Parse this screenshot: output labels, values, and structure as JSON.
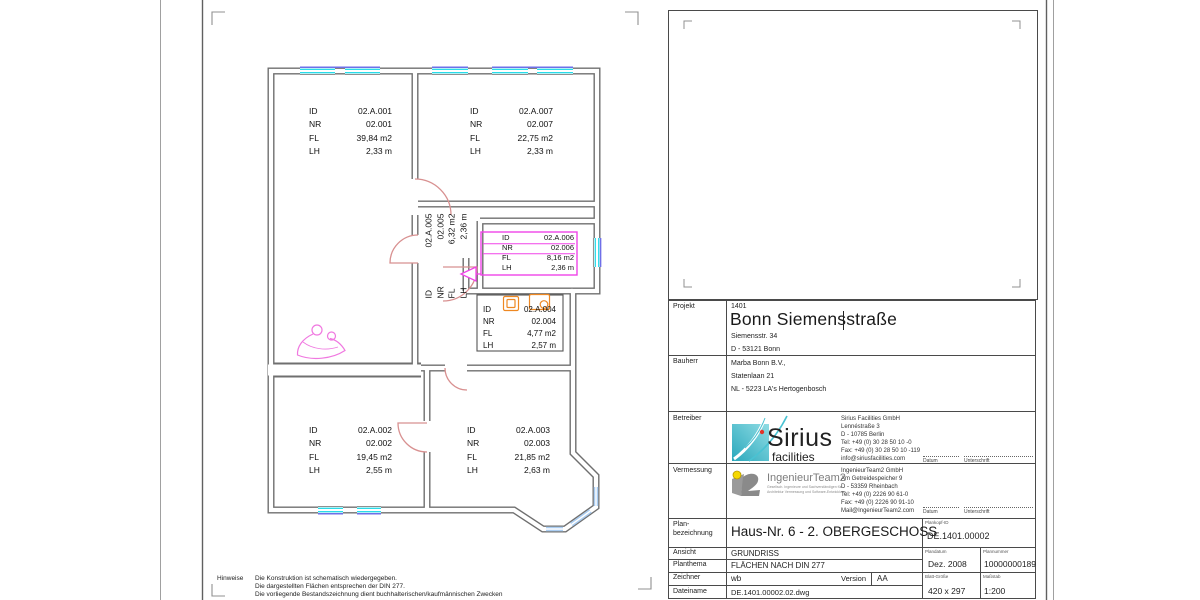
{
  "plan": {
    "labels": {
      "id": "ID",
      "nr": "NR",
      "fl": "FL",
      "lh": "LH"
    },
    "rooms": {
      "r001": {
        "id": "02.A.001",
        "nr": "02.001",
        "fl": "39,84 m2",
        "lh": "2,33 m"
      },
      "r002": {
        "id": "02.A.002",
        "nr": "02.002",
        "fl": "19,45 m2",
        "lh": "2,55 m"
      },
      "r003": {
        "id": "02.A.003",
        "nr": "02.003",
        "fl": "21,85 m2",
        "lh": "2,63 m"
      },
      "r004": {
        "id": "02.A.004",
        "nr": "02.004",
        "fl": "4,77 m2",
        "lh": "2,57 m"
      },
      "r005": {
        "id": "02.A.005",
        "nr": "02.005",
        "fl": "6,32 m2",
        "lh": "2,36 m"
      },
      "r006": {
        "id": "02.A.006",
        "nr": "02.006",
        "fl": "8,16 m2",
        "lh": "2,36 m"
      },
      "r007": {
        "id": "02.A.007",
        "nr": "02.007",
        "fl": "22,75 m2",
        "lh": "2,33 m"
      }
    }
  },
  "titleblock": {
    "projekt": {
      "label": "Projekt",
      "number": "1401",
      "title": "Bonn Siemensstraße",
      "street": "Siemensstr. 34",
      "city": "D - 53121 Bonn"
    },
    "bauherr": {
      "label": "Bauherr",
      "name": "Marba Bonn B.V.,",
      "street": "Statenlaan 21",
      "city": "NL - 5223 LA's Hertogenbosch"
    },
    "betreiber": {
      "label": "Betreiber",
      "logo_text": "Sirius",
      "logo_sub": "facilities",
      "company": "Sirius Facilities GmbH",
      "street": "Lennéstraße 3",
      "city": "D - 10785 Berlin",
      "tel": "Tel:  +49 (0) 30 28 50 10 -0",
      "fax": "Fax: +49 (0) 30 28 50 10 -119",
      "email": "info@siriusfacilities.com"
    },
    "vermessung": {
      "label": "Vermessung",
      "logo_text": "IngenieurTeam2",
      "tagline1": "Gesellsch. Ingenieure und Sachverständigen für",
      "tagline2": "Architektur Vermessung und Software-Entwicklung",
      "company": "IngenieurTeam2 GmbH",
      "street": "Am Getreidespeicher 9",
      "city": "D - 53359 Rheinbach",
      "tel": "Tel:  +49 (0) 2226 90 61-0",
      "fax": "Fax: +49 (0) 2226 90 91-10",
      "email": "Mail@IngenieurTeam2.com"
    },
    "datum_label": "Datum",
    "unterschrift_label": "Unterschrift",
    "planbezeichnung": {
      "label1": "Plan-",
      "label2": "bezeichnung",
      "value": "Haus-Nr. 6 - 2. OBERGESCHOSS"
    },
    "plankopf": {
      "label": "Plankopf-ID",
      "value": "DE.1401.00002"
    },
    "ansicht": {
      "label": "Ansicht",
      "value": "GRUNDRISS"
    },
    "planthema": {
      "label": "Planthema",
      "value": "FLÄCHEN NACH DIN 277"
    },
    "zeichner": {
      "label": "Zeichner",
      "value": "wb",
      "version_label": "Version",
      "version": "AA"
    },
    "dateiname": {
      "label": "Dateiname",
      "value": "DE.1401.00002.02.dwg"
    },
    "plandatum": {
      "label": "Plandatum",
      "value": "Dez. 2008"
    },
    "plannummer": {
      "label": "Plannummer",
      "value": "10000000189"
    },
    "blattgroesse": {
      "label": "Blatt-Größe",
      "value": "420 x 297"
    },
    "massstab": {
      "label": "Maßstab",
      "value": "1:200"
    }
  },
  "hinweise": {
    "label": "Hinweise",
    "line1": "Die Konstruktion ist schematisch wiedergegeben.",
    "line2": "Die dargestellten Flächen entsprechen der DIN 277.",
    "line3": "Die vorliegende Bestandszeichnung dient buchhalterischen/kaufmännischen Zwecken"
  },
  "colors": {
    "wall_gray": "#6f6f6f",
    "window_cyan": "#2adbe8",
    "window_blue": "#6f6fe8",
    "bay_glass": "#aacdf2",
    "door_pink": "#d89090",
    "annotation_magenta": "#f044e8",
    "fixture_orange": "#ee8822",
    "sirius_teal": "#35b6c9",
    "it2_yellow": "#f5d800"
  }
}
